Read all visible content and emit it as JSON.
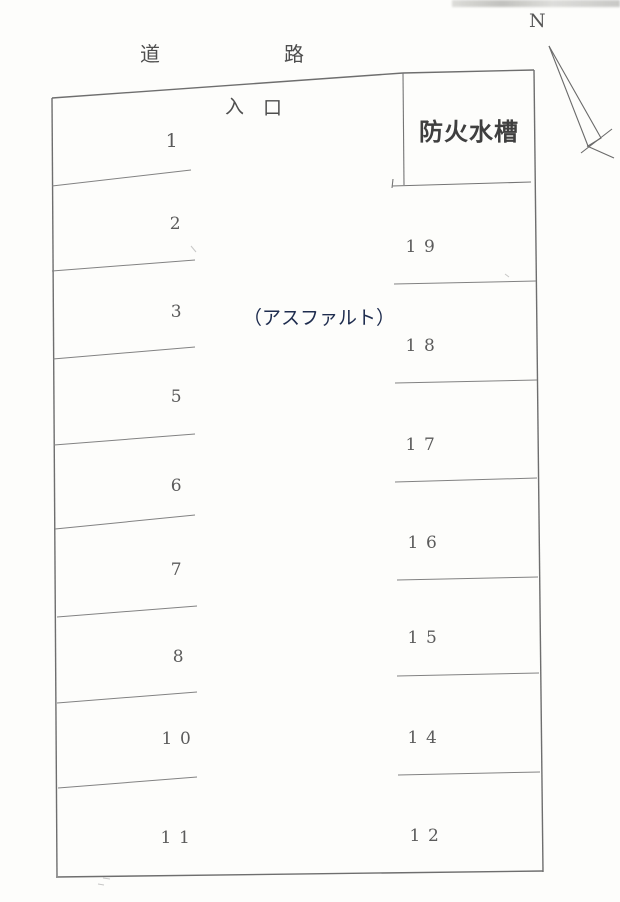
{
  "page": {
    "background_color": "#fdfdfb",
    "line_color": "#777777",
    "kanji_color": "#4e4e4e",
    "number_color": "#5b5b5b",
    "surface_text_color": "#1e2c4e"
  },
  "road": {
    "char1": "道",
    "char2": "路"
  },
  "entrance": {
    "char1": "入",
    "char2": "口"
  },
  "fire_tank": {
    "label": "防火水槽"
  },
  "surface": {
    "label": "（アスファルト）"
  },
  "compass": {
    "label": "N"
  },
  "stalls": {
    "left": [
      {
        "label": "1"
      },
      {
        "label": "2"
      },
      {
        "label": "3"
      },
      {
        "label": "5"
      },
      {
        "label": "6"
      },
      {
        "label": "7"
      },
      {
        "label": "8"
      },
      {
        "label": "10"
      },
      {
        "label": "11"
      }
    ],
    "right": [
      {
        "label": "19"
      },
      {
        "label": "18"
      },
      {
        "label": "17"
      },
      {
        "label": "16"
      },
      {
        "label": "15"
      },
      {
        "label": "14"
      },
      {
        "label": "12"
      }
    ]
  }
}
